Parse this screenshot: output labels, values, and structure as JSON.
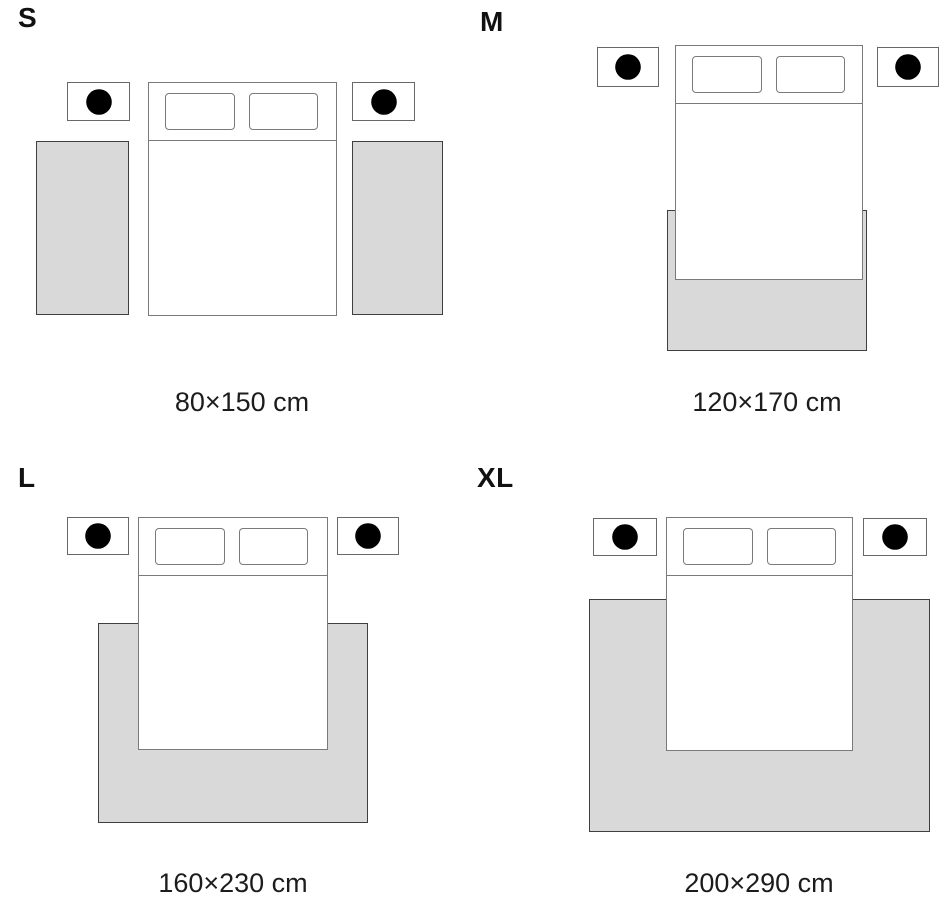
{
  "figure": {
    "type": "rug-size-guide",
    "background": "#ffffff",
    "scene": "top view of a double bed with two pillows and two nightstands with plants, showing rug placement for each size"
  },
  "colors": {
    "rug_fill": "#d9d9d9",
    "rug_outline": "#3f3f3f",
    "furniture_outline": "#7a7a7a",
    "text": "#1c1c1c"
  },
  "icons": {
    "nightstand_icon": "plant-icon"
  },
  "sizes": [
    {
      "code": "S",
      "dimensions": "80×150 cm",
      "rug_placement": "two runner rugs, one on each side of the bed"
    },
    {
      "code": "M",
      "dimensions": "120×170 cm",
      "rug_placement": "one rug under the foot of the bed, extending past the end"
    },
    {
      "code": "L",
      "dimensions": "160×230 cm",
      "rug_placement": "one rug under the lower half of the bed, extending on both sides and past the end"
    },
    {
      "code": "XL",
      "dimensions": "200×290 cm",
      "rug_placement": "one large rug under most of the bed, extending widely on both sides and past the end"
    }
  ]
}
